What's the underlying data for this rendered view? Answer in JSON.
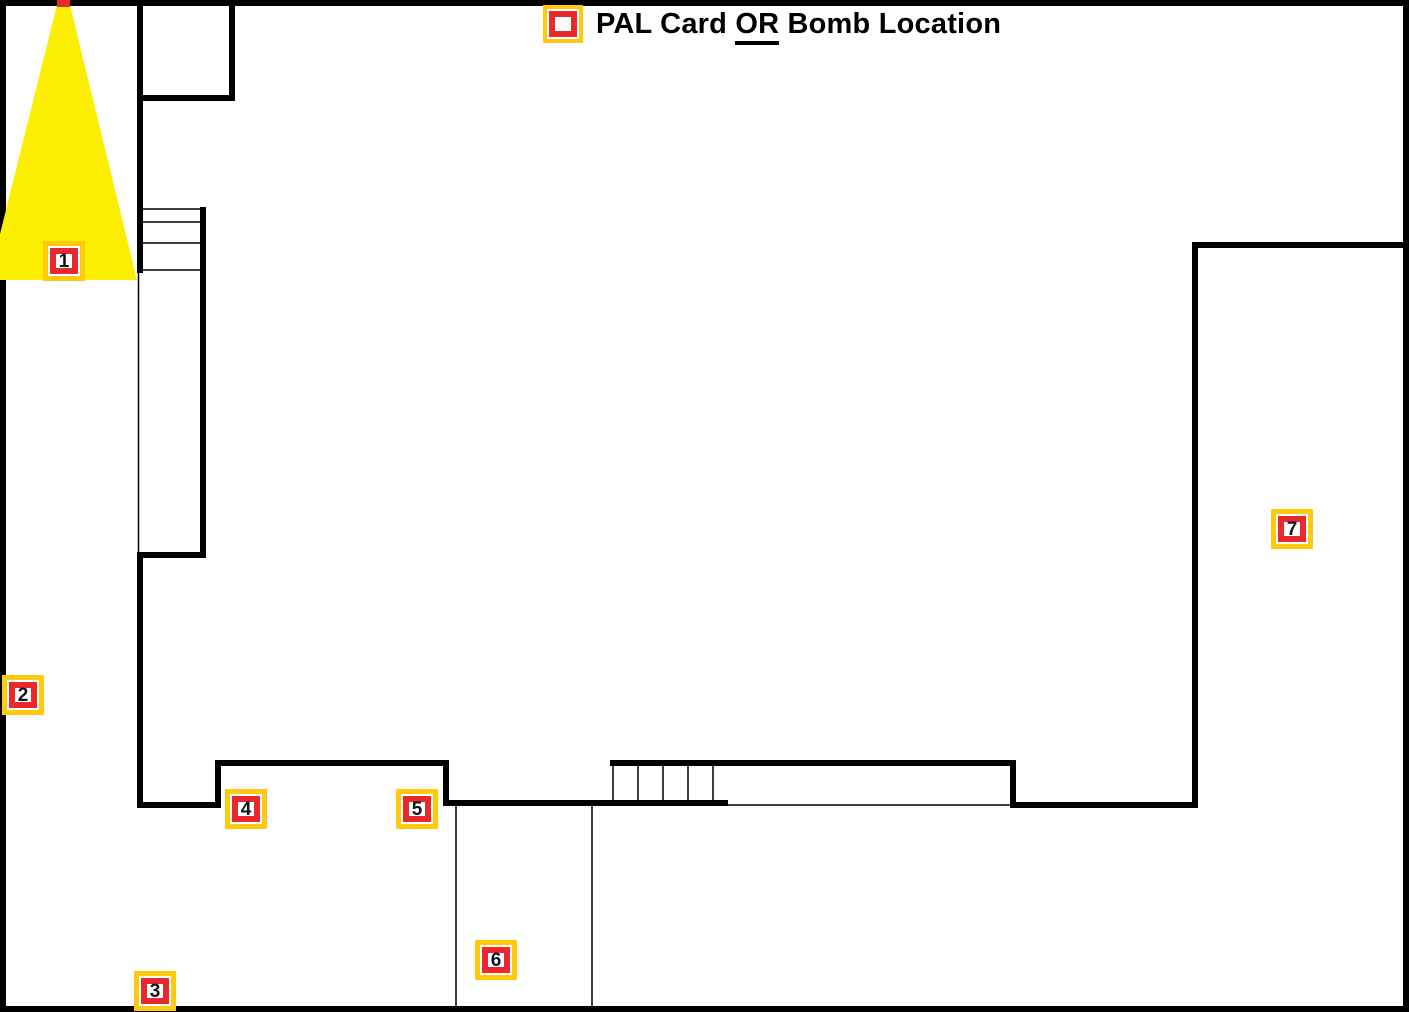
{
  "legend": {
    "icon": "pal-bomb-marker-icon",
    "text_before": "PAL Card",
    "text_underlined": "OR",
    "text_after": "Bomb Location"
  },
  "markers": [
    {
      "label": "1",
      "x": 43,
      "y": 241
    },
    {
      "label": "2",
      "x": 2,
      "y": 675
    },
    {
      "label": "3",
      "x": 134,
      "y": 971
    },
    {
      "label": "4",
      "x": 225,
      "y": 789
    },
    {
      "label": "5",
      "x": 396,
      "y": 789
    },
    {
      "label": "6",
      "x": 475,
      "y": 940
    },
    {
      "label": "7",
      "x": 1271,
      "y": 509
    }
  ],
  "colors": {
    "marker_yellow": "#FFC90E",
    "marker_red": "#E8292D",
    "cone_yellow": "#FBEE00",
    "wall_black": "#000000",
    "number_dark": "#10151C"
  }
}
